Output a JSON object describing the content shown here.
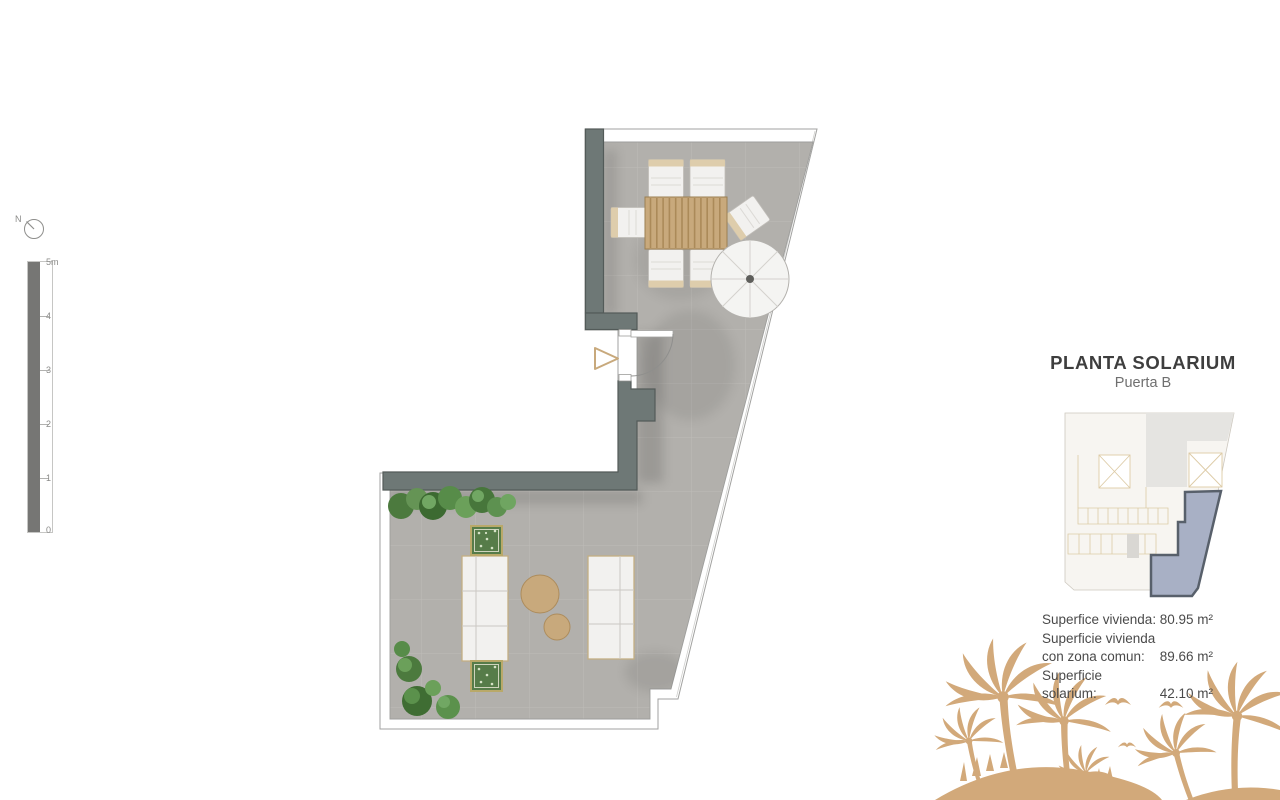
{
  "title_block": {
    "title": "PLANTA SOLARIUM",
    "subtitle": "Puerta B"
  },
  "surfaces": {
    "rows": [
      {
        "label": "Superfice vivienda:",
        "value": "80.95 m²"
      },
      {
        "label": "Superficie vivienda con zona comun:",
        "value": "89.66 m²"
      },
      {
        "label": "Superficie solarium:",
        "value": "42.10 m²"
      }
    ]
  },
  "scale_bar": {
    "labels": [
      "5m",
      "4",
      "3",
      "2",
      "1",
      "0"
    ]
  },
  "north_indicator": {
    "label": "N"
  },
  "colors": {
    "floor": "#b2b0ac",
    "wall": "#6e7876",
    "wall_edge": "#535b59",
    "wood": "#c8a97c",
    "gold": "#d2a97a",
    "green": "#4c7a3e",
    "unit_fill": "#a8b0c5",
    "unit_border": "#58606b",
    "keyplan_ivory": "#f7f5f1",
    "keyplan_gray": "#e5e4e1",
    "keyplan_line": "#ddcba6",
    "title": "#3e3e3e",
    "subtitle": "#6f6f6f",
    "text": "#4a4a4a",
    "scale": "#8b8b89"
  }
}
